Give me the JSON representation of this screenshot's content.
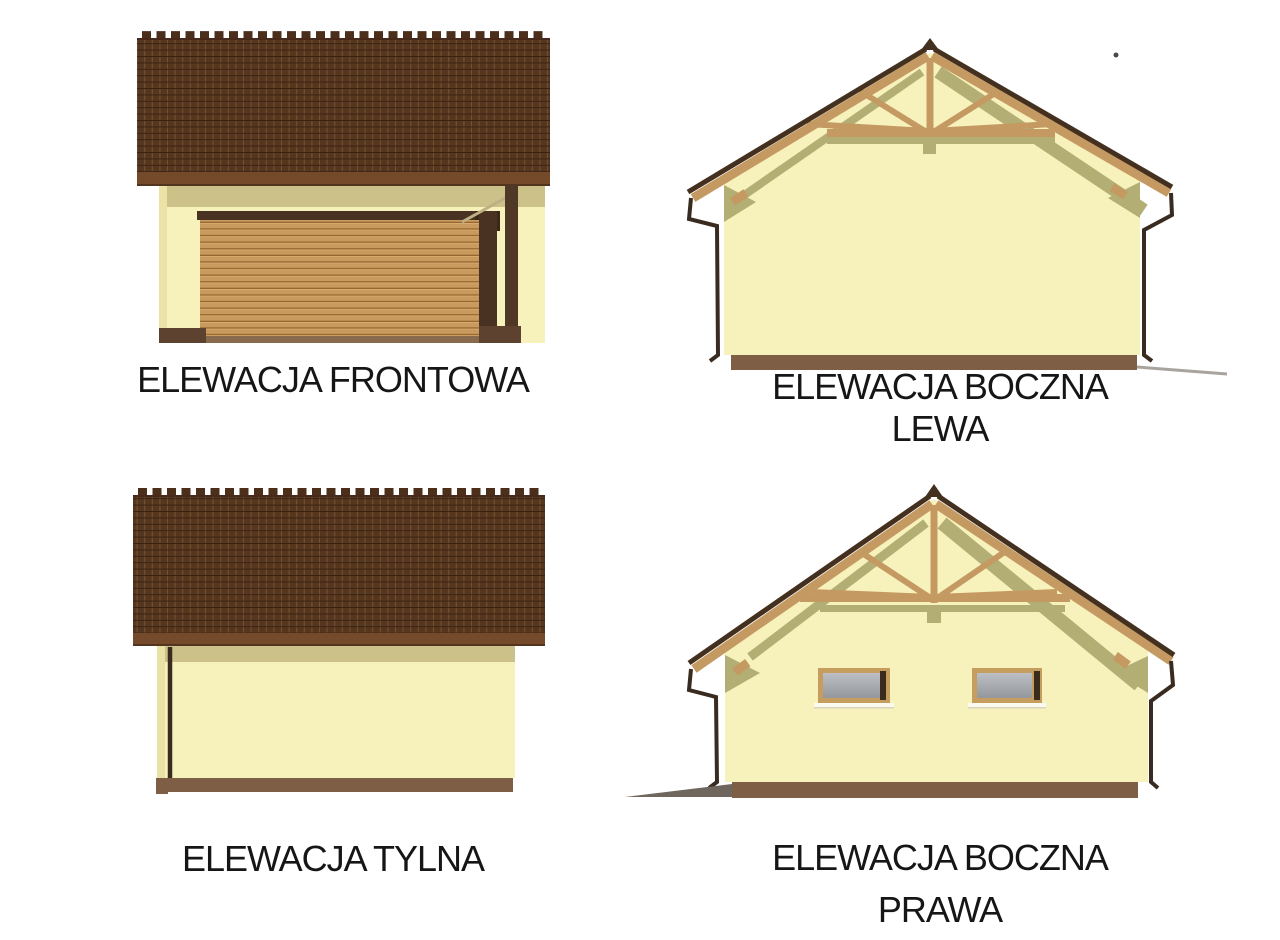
{
  "sheet": {
    "title": "garage elevation sheet",
    "background": "#ffffff"
  },
  "palette": {
    "roof_tile": "#553720",
    "roof_grid_light": "#7a512e",
    "roof_grid_dark": "#3a2212",
    "ridge": "#4c2f1b",
    "eave_strip": "#744a2a",
    "wall_cream": "#f7f1bb",
    "band_olive": "#cbc189",
    "shadow_olive": "#b2ae74",
    "truss_wood": "#c59a62",
    "roof_edge_dark": "#43301f",
    "door_wood": "#c99a5e",
    "door_wood_line": "#95682f",
    "frame_dark": "#4a3222",
    "post_brown": "#503826",
    "foundation": "#7e5f45",
    "foundation_dark": "#5d4230",
    "downspout": "#3a2b20",
    "window_frame": "#c59d5e",
    "glass_gray": "#a5a8ad",
    "ground_shadow": "#6f665d",
    "label_color": "#161616"
  },
  "elevations": [
    {
      "id": "front",
      "label": "ELEWACJA FRONTOWA"
    },
    {
      "id": "side-left",
      "label": "ELEWACJA BOCZNA",
      "label2": "LEWA"
    },
    {
      "id": "rear",
      "label": "ELEWACJA TYLNA"
    },
    {
      "id": "side-right",
      "label": "ELEWACJA BOCZNA",
      "label2": "PRAWA"
    }
  ]
}
